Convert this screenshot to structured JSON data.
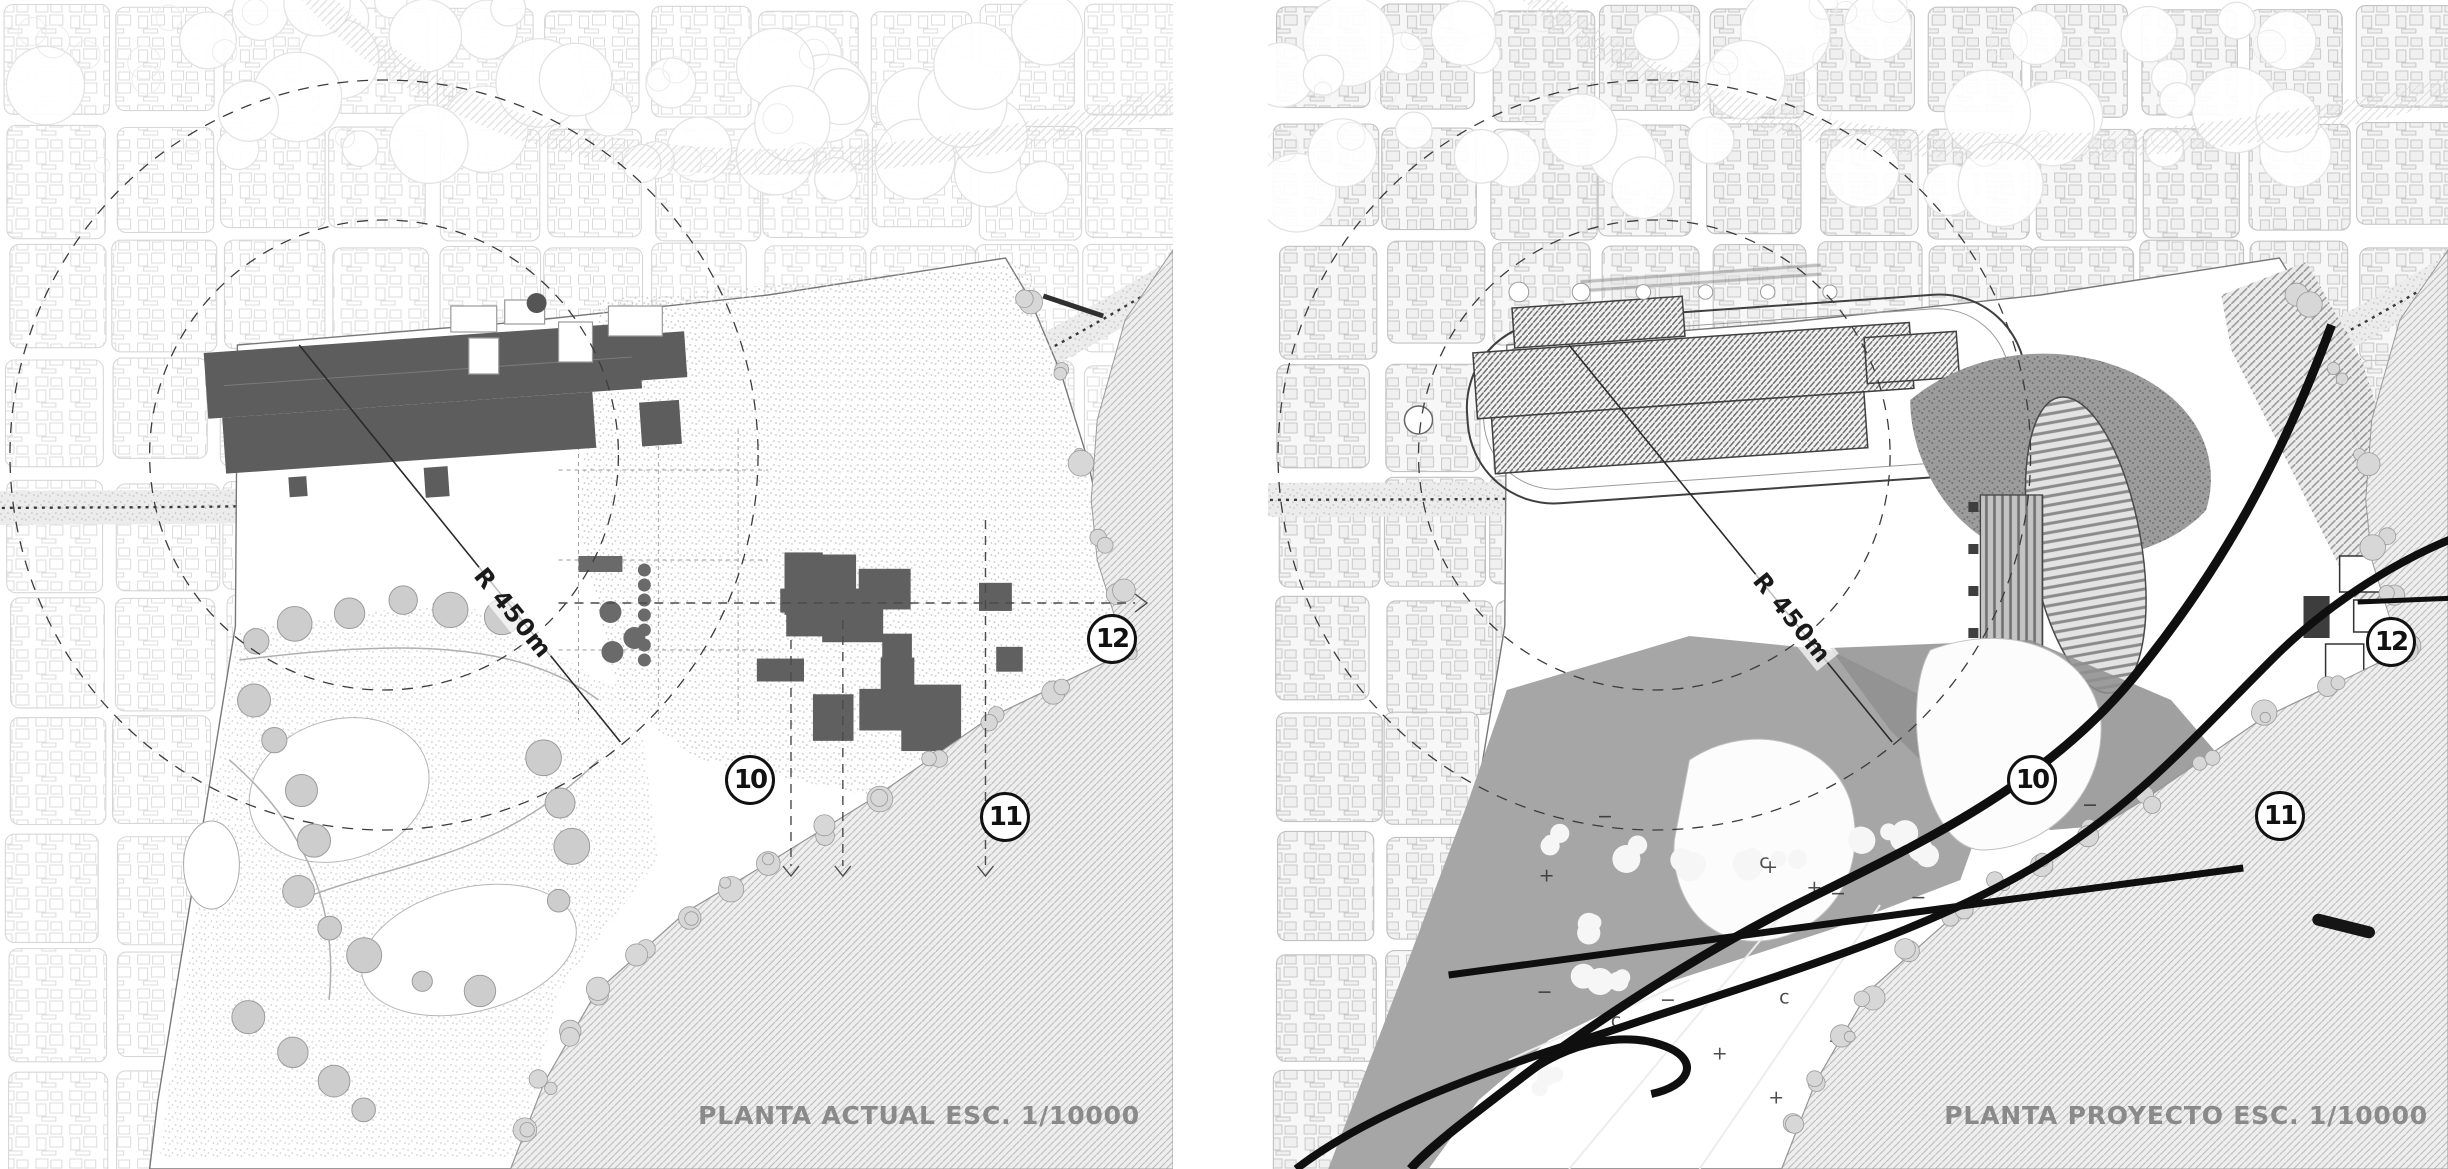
{
  "panels": [
    {
      "id": "planta-actual",
      "caption": "PLANTA ACTUAL ESC. 1/10000",
      "radius_label": "R 450m",
      "markers": [
        {
          "label": "10"
        },
        {
          "label": "11"
        },
        {
          "label": "12"
        }
      ]
    },
    {
      "id": "planta-proyecto",
      "caption": "PLANTA PROYECTO ESC. 1/10000",
      "radius_label": "R 450m",
      "markers": [
        {
          "label": "10"
        },
        {
          "label": "11"
        },
        {
          "label": "12"
        }
      ]
    }
  ],
  "colors": {
    "building_solid_gray": "#5d5d5d",
    "project_path_black": "#0f0f0f",
    "caption_gray": "#8a8a8a",
    "sea_hatch_line": "#bcbcbc",
    "landscape_gray": "#a6a6a6"
  }
}
